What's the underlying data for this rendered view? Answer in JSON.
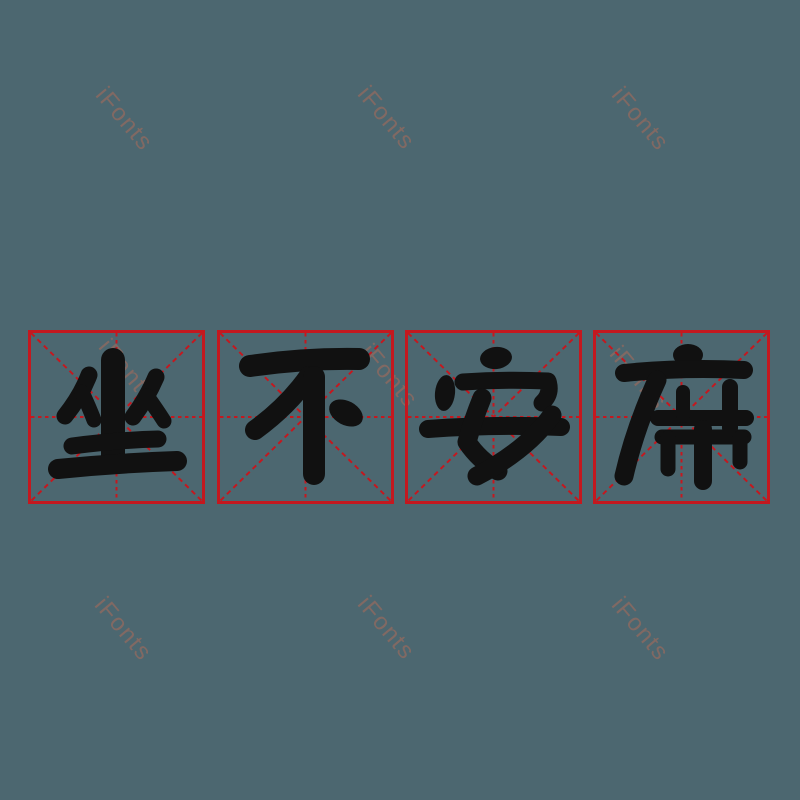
{
  "canvas": {
    "background_color": "#4C6770"
  },
  "phrase": {
    "text": "坐不安席",
    "characters": [
      {
        "char": "坐"
      },
      {
        "char": "不"
      },
      {
        "char": "安"
      },
      {
        "char": "席"
      }
    ]
  },
  "grid": {
    "box_count": 4,
    "line_color": "#C4181F",
    "glyph_color": "#111111"
  },
  "watermark": {
    "text": "iFonts",
    "color": "#A26A5C",
    "opacity": 0.62,
    "rotation_deg": 50,
    "count": 9
  }
}
